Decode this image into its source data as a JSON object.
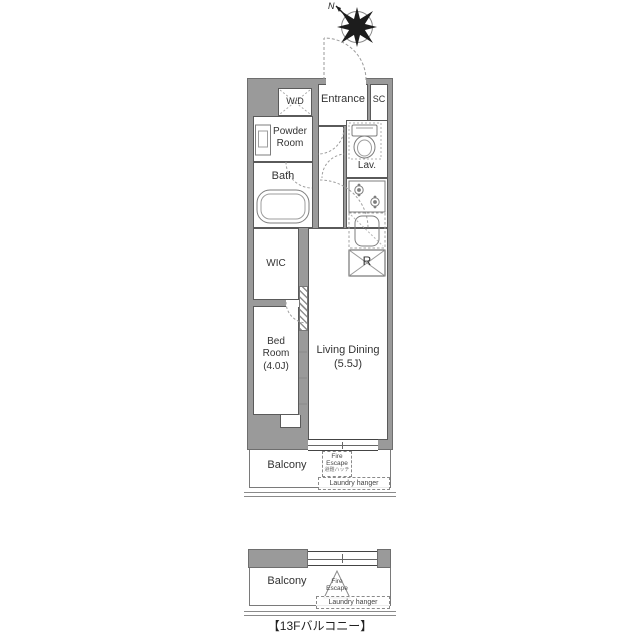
{
  "compass": {
    "north": "N"
  },
  "unit": {
    "wd": "W/D",
    "entrance": "Entrance",
    "sc": "SC",
    "powder_room": "Powder Room",
    "lav": "Lav.",
    "bath": "Bath",
    "wic": "WIC",
    "bed_room": "Bed Room",
    "bed_size": "(4.0J)",
    "living": "Living Dining",
    "living_size": "(5.5J)",
    "fridge": "R"
  },
  "balcony": {
    "label": "Balcony",
    "fire_escape": "Fire Escape",
    "fire_escape_note": "避難ハッチ",
    "laundry": "Laundry hanger"
  },
  "balcony_13f": {
    "label": "Balcony",
    "fire_escape": "Fire Escape",
    "laundry": "Laundry hanger",
    "caption": "【13Fバルコニー】"
  },
  "colors": {
    "wall": "#9a9a9a",
    "outline": "#5a5a5a",
    "fixture": "#888888"
  }
}
